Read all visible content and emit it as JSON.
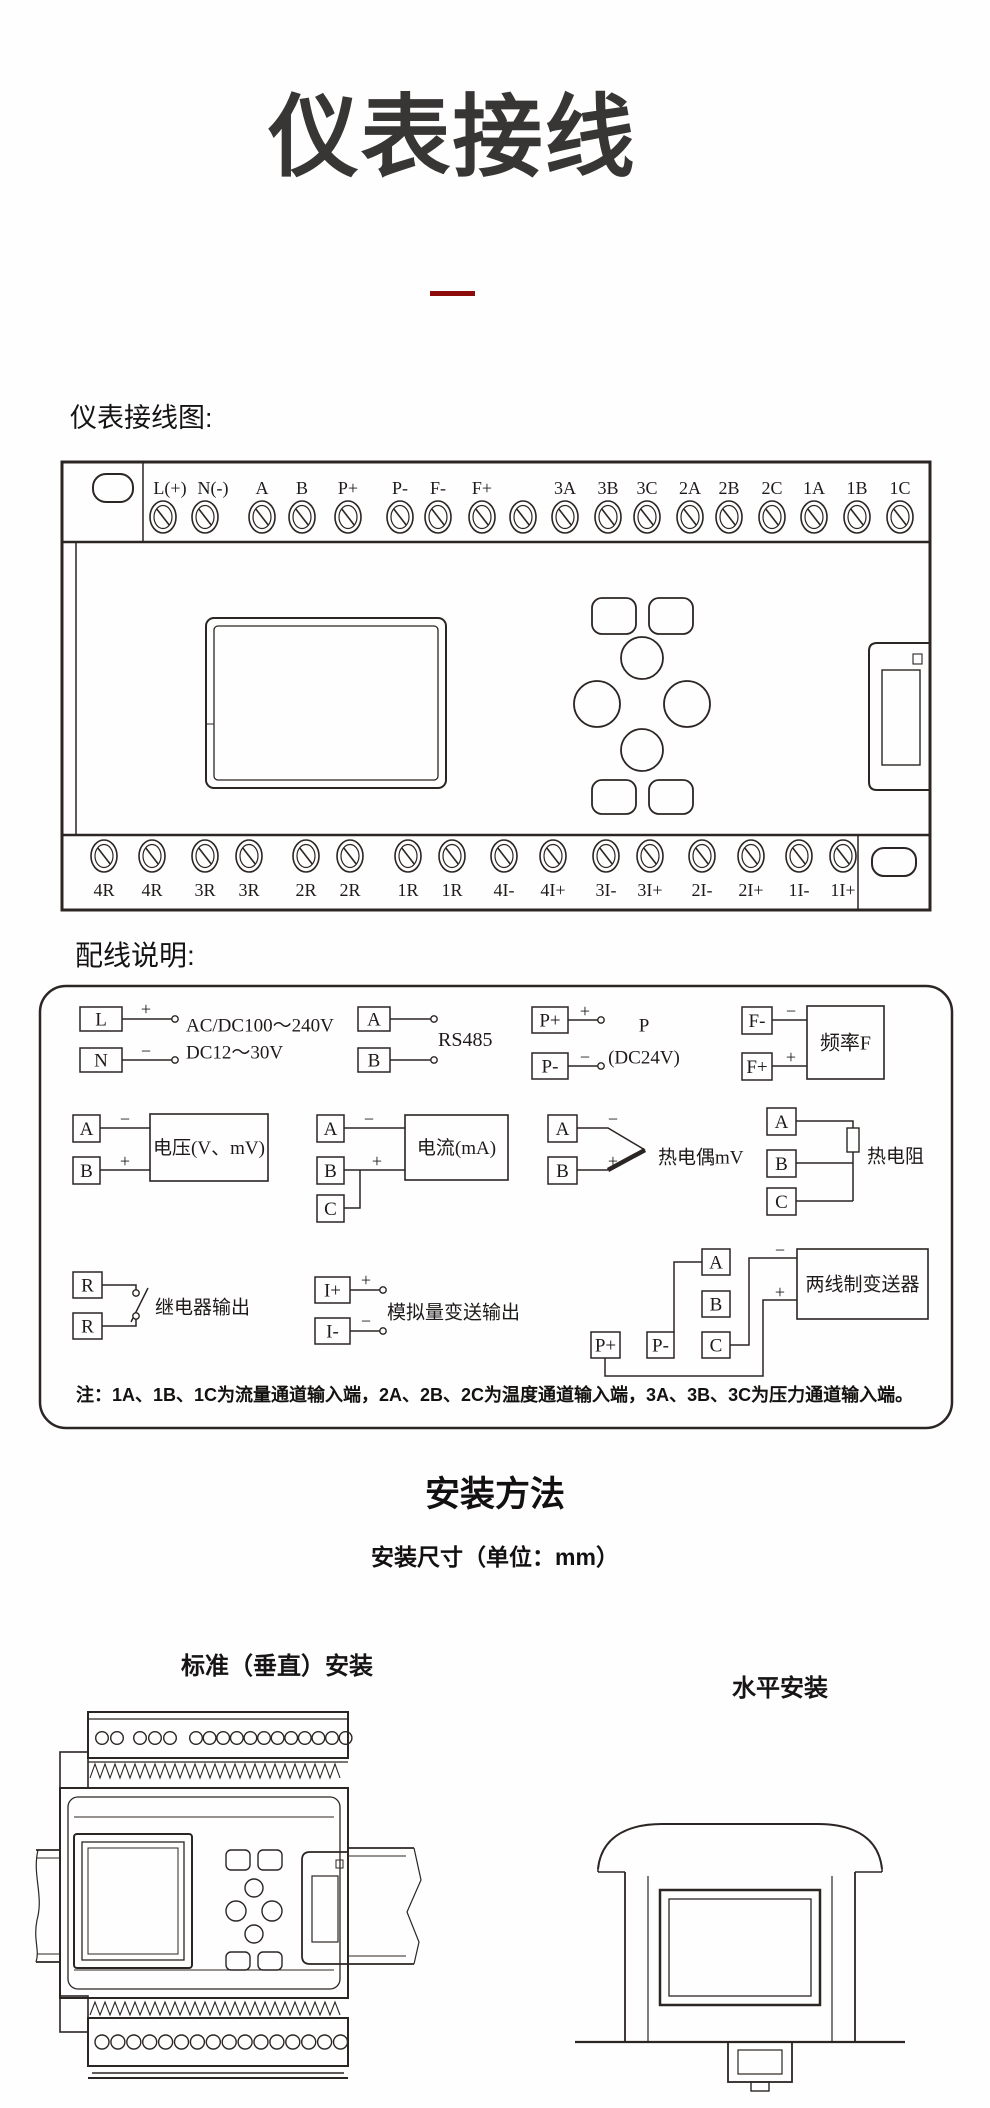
{
  "page": {
    "title": "仪表接线",
    "accent_color": "#8e0b0b"
  },
  "wiring_diagram": {
    "heading": "仪表接线图:",
    "top_terminals": [
      "L(+)",
      "N(-)",
      "A",
      "B",
      "P+",
      "P-",
      "F-",
      "F+",
      "3A",
      "3B",
      "3C",
      "2A",
      "2B",
      "2C",
      "1A",
      "1B",
      "1C"
    ],
    "bottom_terminals": [
      "4R",
      "4R",
      "3R",
      "3R",
      "2R",
      "2R",
      "1R",
      "1R",
      "4I-",
      "4I+",
      "3I-",
      "3I+",
      "2I-",
      "2I+",
      "1I-",
      "1I+"
    ]
  },
  "wiring_notes": {
    "heading": "配线说明:",
    "power": {
      "t1": "L",
      "t2": "N",
      "p1": "+",
      "p2": "−",
      "line1": "AC/DC100～240V",
      "line2": "DC12～30V"
    },
    "rs485": {
      "t1": "A",
      "t2": "B",
      "label": "RS485"
    },
    "p_supply": {
      "t1": "P+",
      "t2": "P-",
      "p1": "+",
      "p2": "−",
      "line1": "P",
      "line2": "(DC24V)"
    },
    "frequency": {
      "t1": "F-",
      "t2": "F+",
      "p1": "−",
      "p2": "+",
      "label": "频率F"
    },
    "voltage": {
      "t1": "A",
      "t2": "B",
      "p1": "−",
      "p2": "+",
      "label": "电压(V、mV)"
    },
    "current": {
      "t1": "A",
      "t2": "B",
      "t3": "C",
      "p1": "−",
      "p2": "+",
      "label": "电流(mA)"
    },
    "thermocouple": {
      "t1": "A",
      "t2": "B",
      "p1": "−",
      "p2": "+",
      "label": "热电偶mV"
    },
    "rtd": {
      "t1": "A",
      "t2": "B",
      "t3": "C",
      "label": "热电阻"
    },
    "relay": {
      "t1": "R",
      "t2": "R",
      "label": "继电器输出"
    },
    "analog_out": {
      "t1": "I+",
      "t2": "I-",
      "p1": "+",
      "p2": "−",
      "label": "模拟量变送输出"
    },
    "two_wire": {
      "t1": "A",
      "t2": "B",
      "t3": "C",
      "t4": "P+",
      "t5": "P-",
      "p1": "−",
      "p2": "+",
      "label": "两线制变送器"
    },
    "note": "注：1A、1B、1C为流量通道输入端，2A、2B、2C为温度通道输入端，3A、3B、3C为压力通道输入端。"
  },
  "installation": {
    "heading": "安装方法",
    "subheading": "安装尺寸（单位：mm）",
    "vertical_label": "标准（垂直）安装",
    "horizontal_label": "水平安装"
  }
}
